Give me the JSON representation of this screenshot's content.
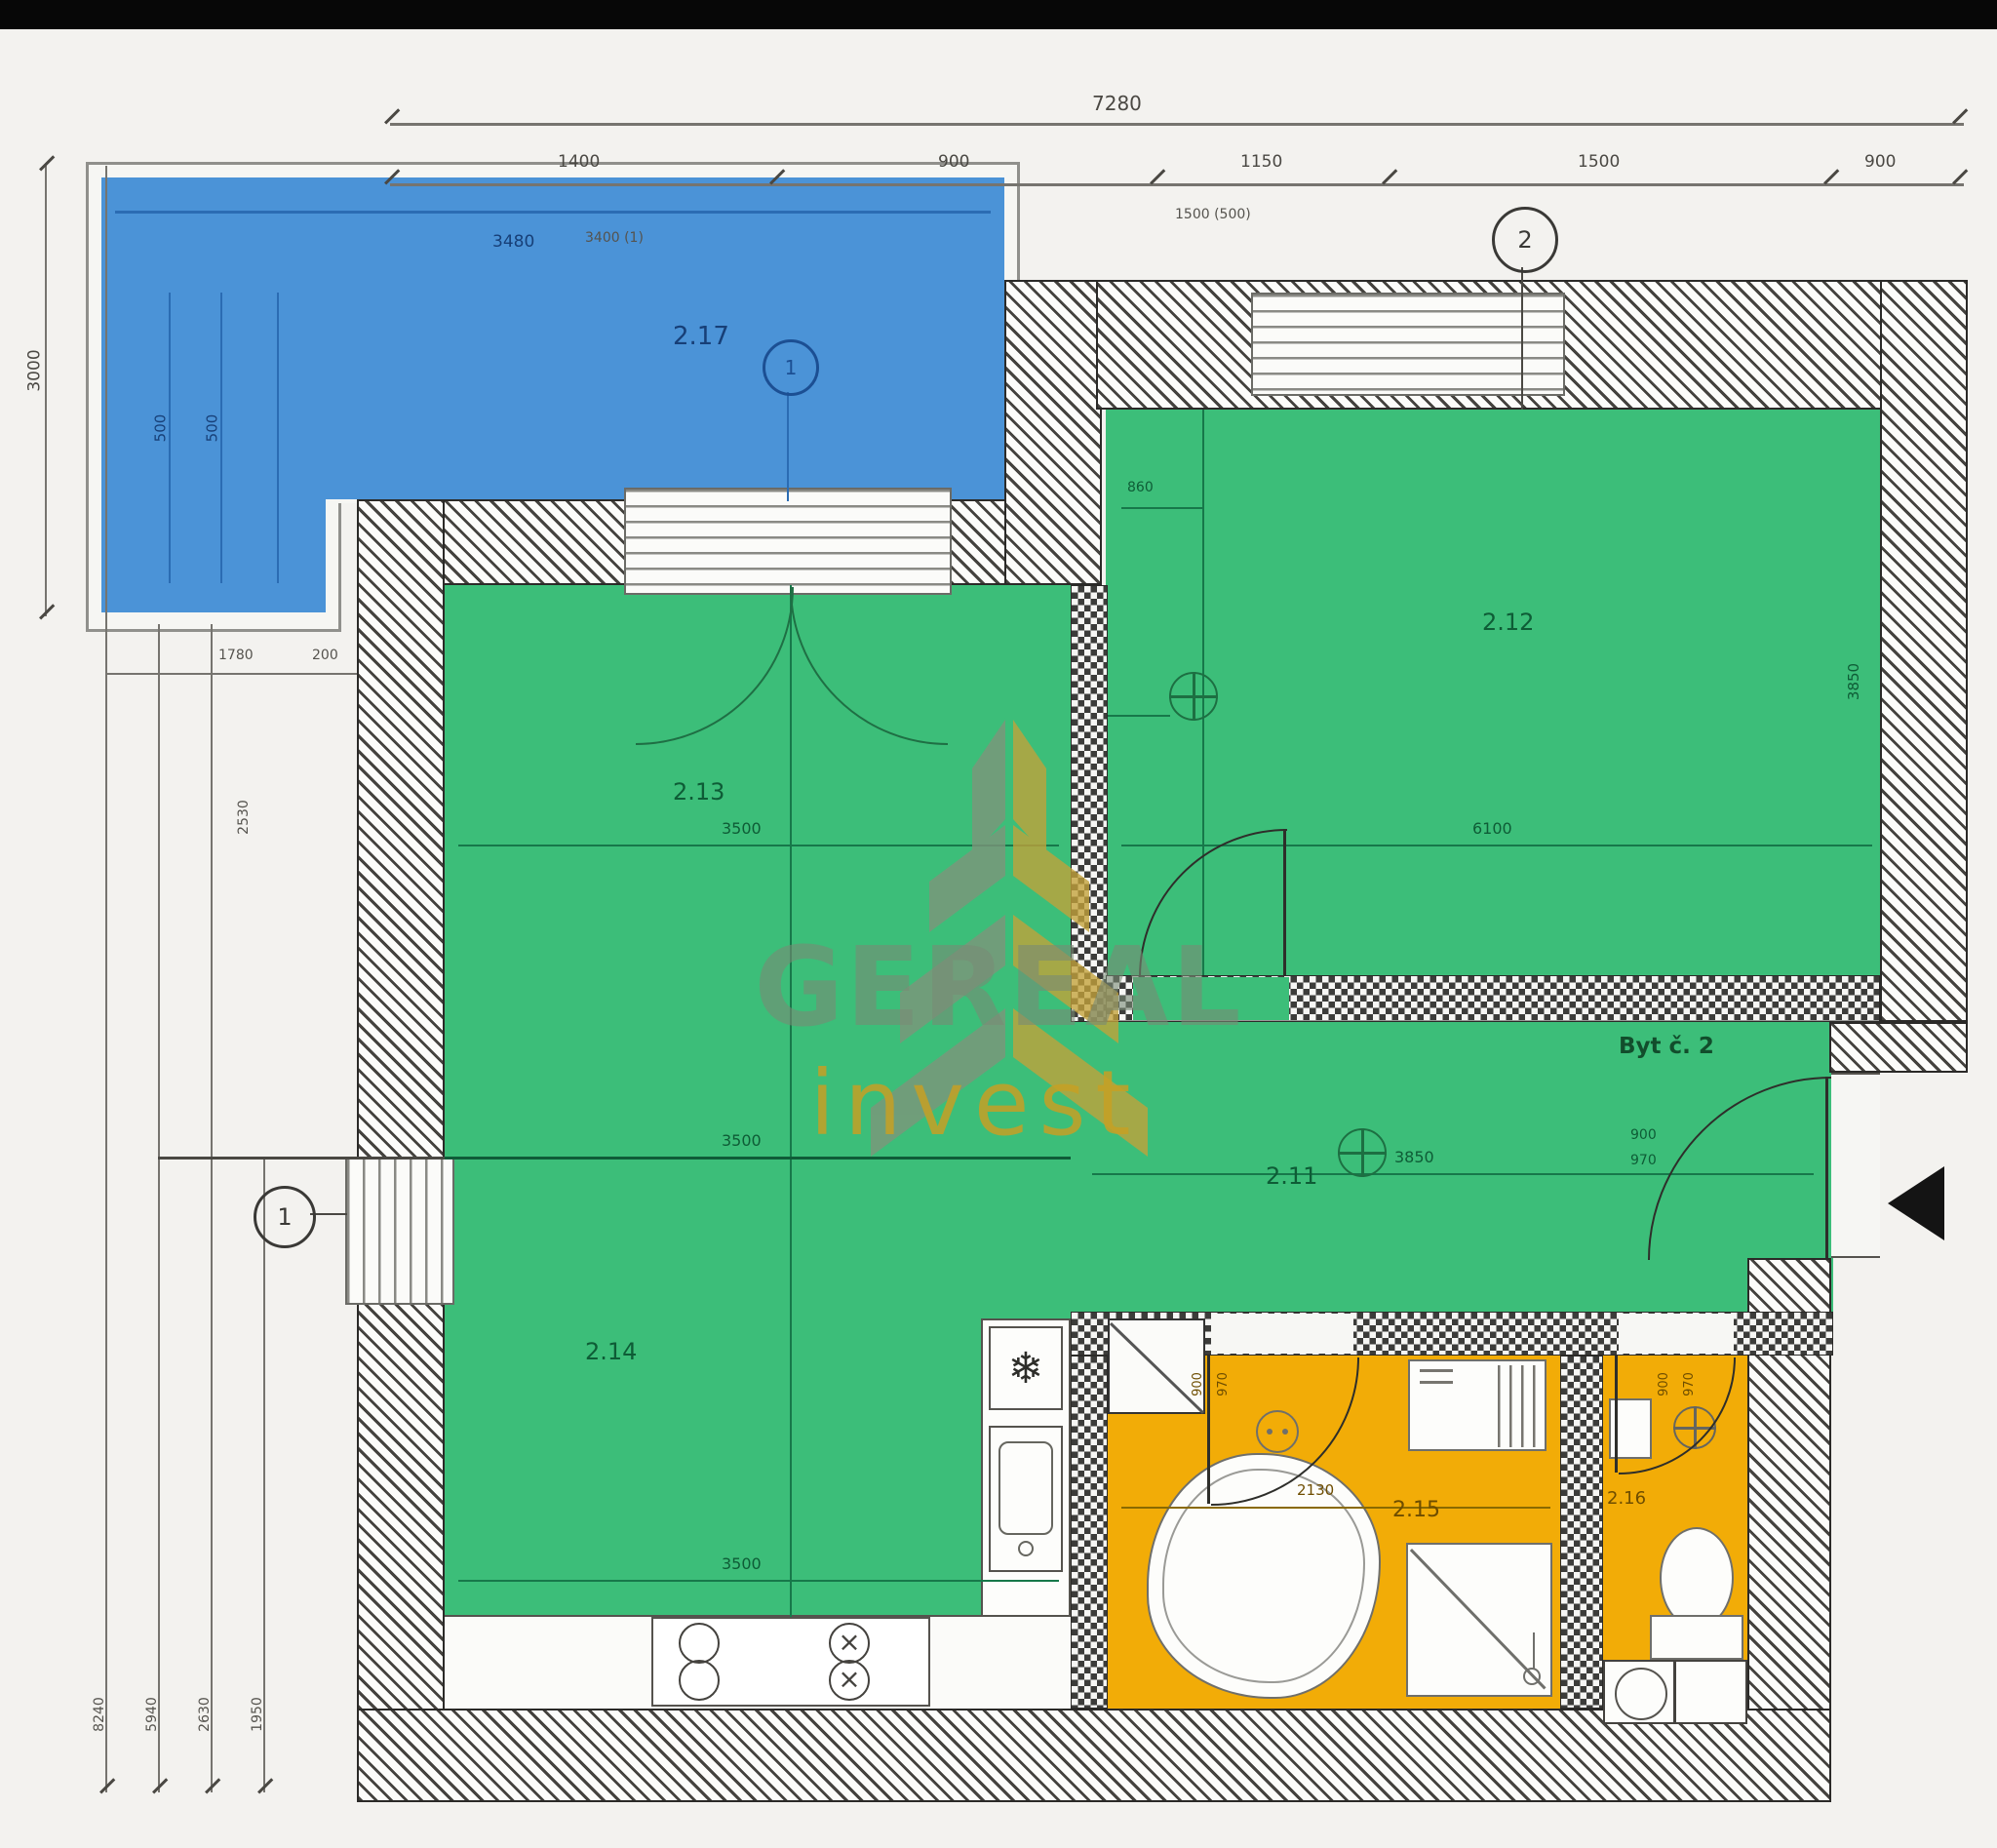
{
  "watermark": {
    "brand": "GEREAL",
    "sub": "invest"
  },
  "apartment": {
    "label": "Byt č. 2"
  },
  "rooms": {
    "terrace": "2.17",
    "living": "2.13",
    "kitchen": "2.14",
    "bedroom": "2.12",
    "hall": "2.11",
    "bathroom": "2.15",
    "wc": "2.16"
  },
  "markers": {
    "one": "1",
    "two": "2"
  },
  "icons": {
    "snowflake": "❄",
    "burner_cross": "×"
  },
  "dims": {
    "top_total": "7280",
    "t1": "1400",
    "t2": "900",
    "t3": "1150",
    "t4": "1500",
    "t5": "900",
    "sub1": "3400 (1)",
    "sub2": "1500 (500)",
    "left_h": "3000",
    "terr_w": "3480",
    "terr_a": "500",
    "terr_b": "500",
    "lm1": "1780",
    "lm2": "200",
    "lrot1": "2530",
    "b1": "8240",
    "b2": "5940",
    "b3": "2630",
    "b4": "1950",
    "living_line": "3500",
    "kitchen_line1": "3500",
    "kitchen_line2": "3500",
    "bedroom_line": "6100",
    "bedroom_side": "3850",
    "bedroom_top": "860",
    "hall_line": "3850",
    "bath_line": "2130",
    "bath_s1": "900",
    "bath_s2": "970",
    "wc_s1": "900",
    "wc_s2": "970",
    "ent_s1": "900",
    "ent_s2": "970"
  },
  "colors": {
    "terrace": "#4b93d7",
    "room_green": "#3cbe79",
    "wet_orange": "#f2ac07"
  }
}
